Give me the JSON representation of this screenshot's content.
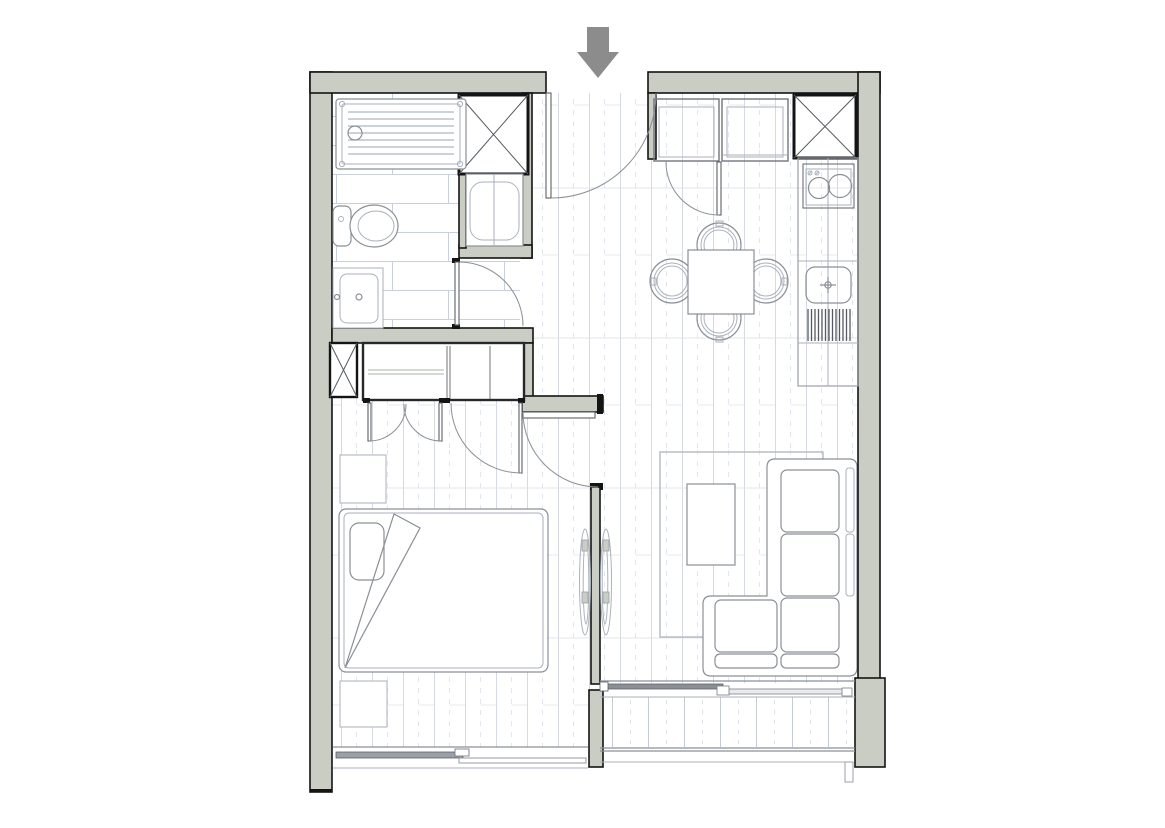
{
  "meta": {
    "title": "One-bedroom apartment floor plan",
    "view": "top-down architectural plan",
    "canvas": {
      "width_px": 1165,
      "height_px": 828
    }
  },
  "colors": {
    "canvas": "#ffffff",
    "wall-fill": "#c9cdc3",
    "wall-stroke": "#141414",
    "fixture": "#8a8f96",
    "fixture-light": "#aab2bc",
    "door-arc": "#8a8f96",
    "plank-line": "#d5d9e2",
    "tile-line": "#c9d0dd",
    "deck-line": "#c6ccd6",
    "arrow": "#8c8c8c",
    "glass-dark": "#9aa0a8",
    "rug-stroke": "#b9bdc1"
  },
  "entry": {
    "arrow_icon": "entry-direction-arrow",
    "door": "entry-door-90deg-swing"
  },
  "rooms": [
    {
      "id": "entry-hall",
      "floor": "timber-planks",
      "position": "top-center"
    },
    {
      "id": "bathroom",
      "floor": "large-format-tiles",
      "position": "top-left"
    },
    {
      "id": "kitchen-dining",
      "floor": "timber-planks",
      "position": "top-right"
    },
    {
      "id": "bedroom",
      "floor": "timber-planks",
      "position": "bottom-left"
    },
    {
      "id": "living-room",
      "floor": "timber-planks",
      "position": "bottom-right"
    },
    {
      "id": "balcony",
      "floor": "decking",
      "position": "bottom-right-outside"
    }
  ],
  "fixtures": {
    "bathroom": [
      "walk-in-shower-tray",
      "shower-drain",
      "toilet-with-cistern",
      "vanity-basin",
      "washing-machine-niche",
      "bathroom-door"
    ],
    "services": [
      "service-shaft-bathroom",
      "service-shaft-kitchen-corner",
      "service-shaft-wardrobe"
    ],
    "kitchen": [
      "tall-cabinet-left",
      "tall-cabinet-right",
      "cabinet-door-swing",
      "worktop-run",
      "cooktop-two-burners",
      "cooktop-control-knobs",
      "kitchen-sink-with-tap-cross",
      "drainer-grooves",
      "dining-table-square",
      "dining-chair-north",
      "dining-chair-south",
      "dining-chair-west",
      "dining-chair-east"
    ],
    "bedroom": [
      "built-in-wardrobe",
      "wardrobe-bifold-doors",
      "wardrobe-hinged-door",
      "double-bed",
      "pillow",
      "folded-blanket-corner",
      "nightstand-north",
      "nightstand-south",
      "bedroom-door",
      "sliding-window-south"
    ],
    "living": [
      "area-rug",
      "coffee-table",
      "l-shaped-sofa",
      "partition-wall",
      "double-sided-panel-left",
      "double-sided-panel-right",
      "sliding-glass-door"
    ],
    "balcony": [
      "glass-balustrade",
      "deck-boards",
      "downpipe-post"
    ]
  }
}
